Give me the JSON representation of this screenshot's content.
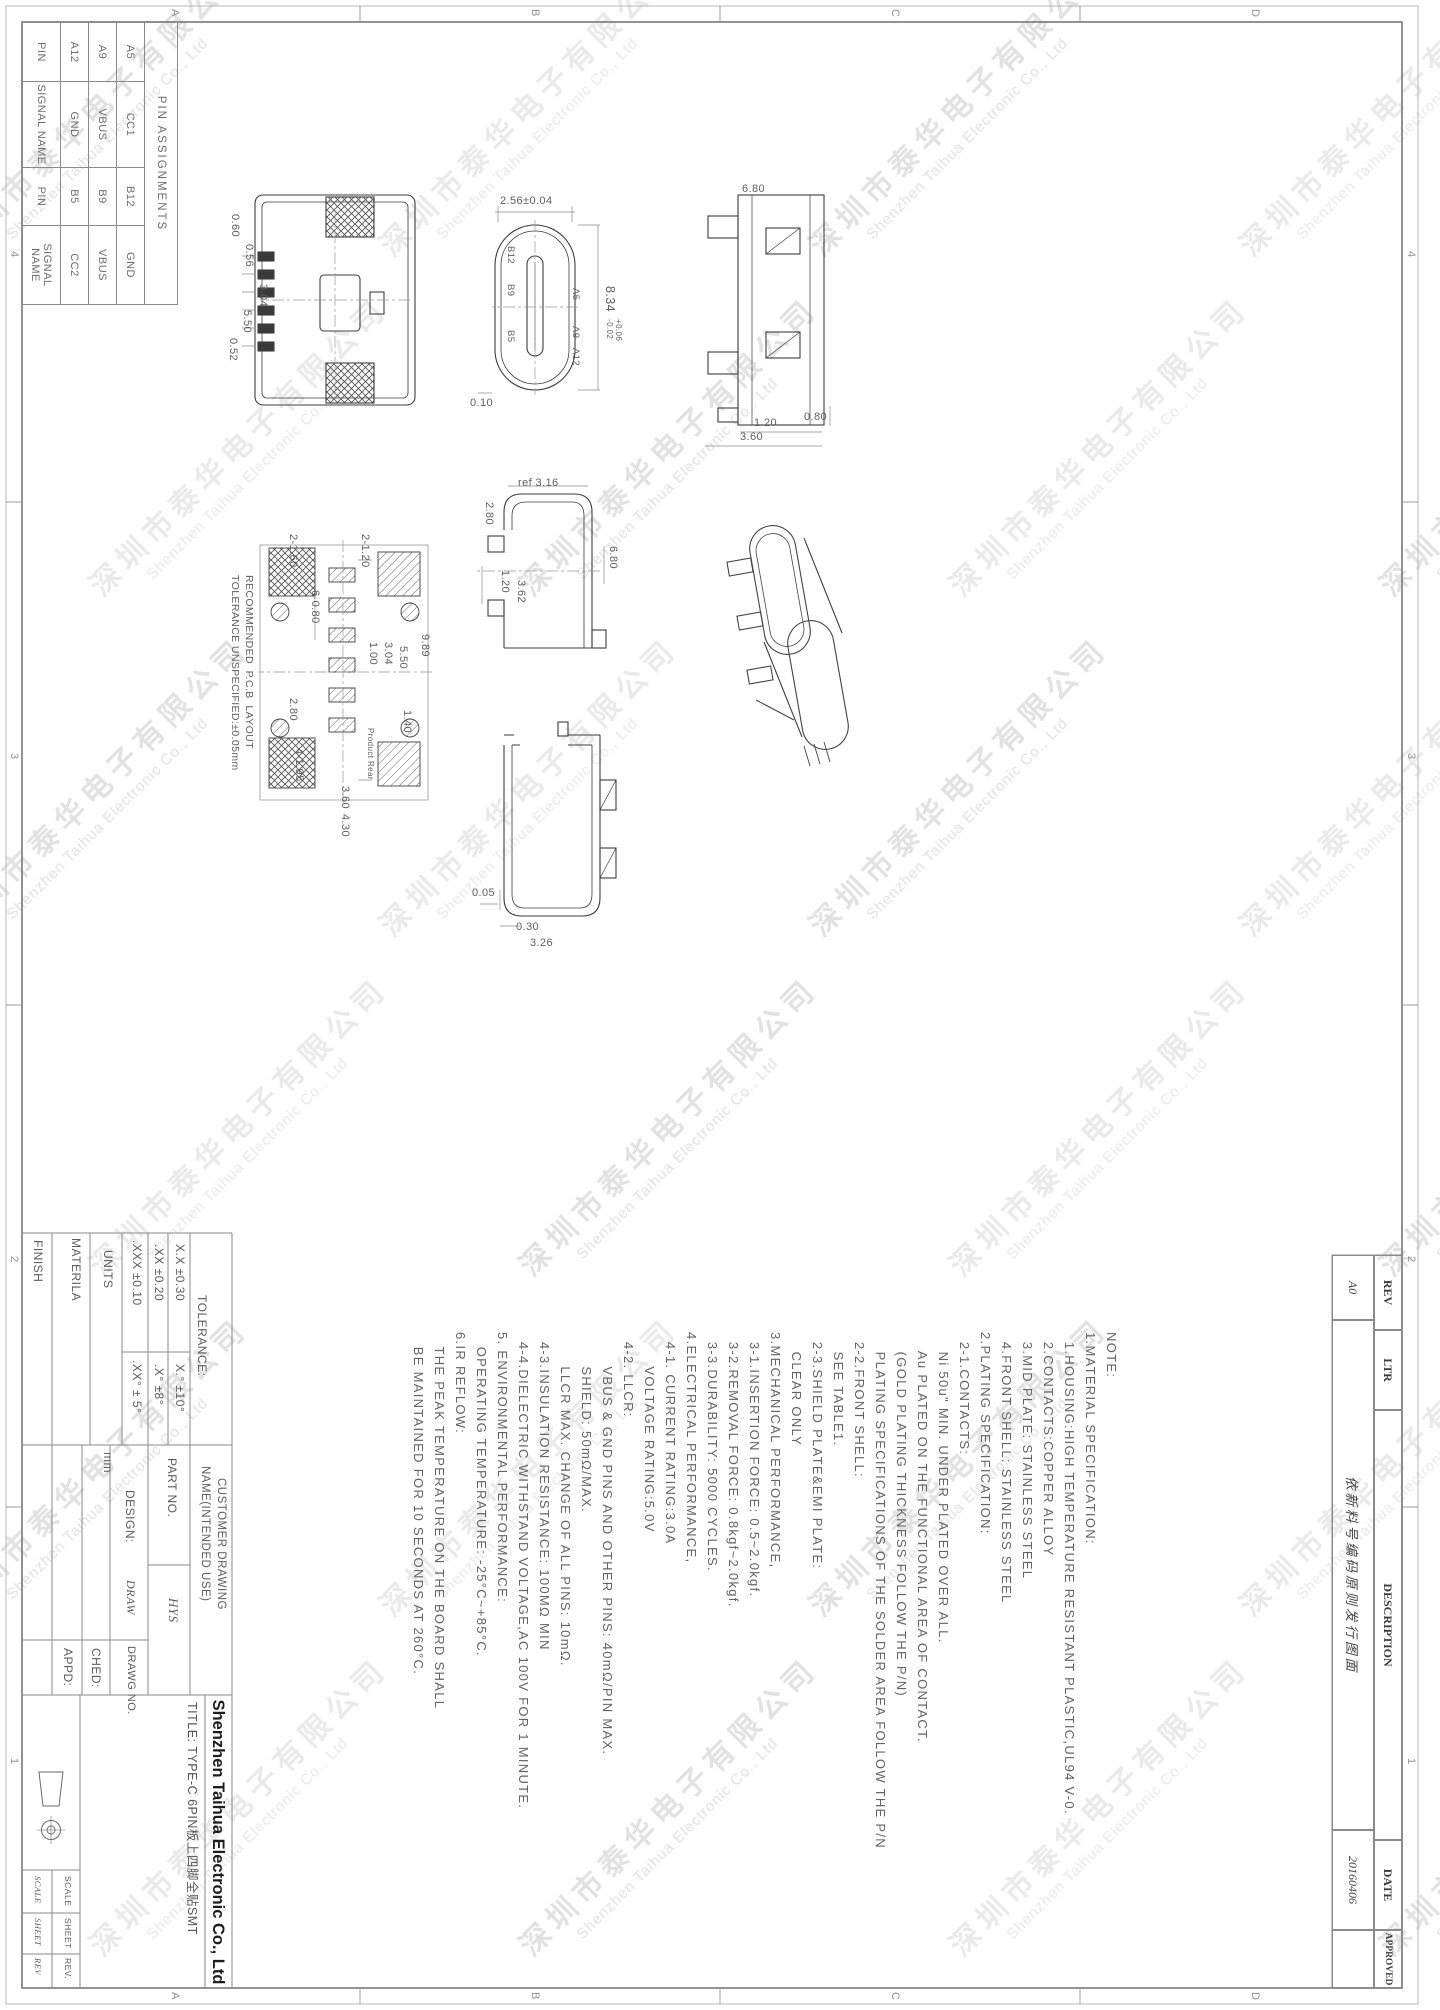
{
  "watermark": {
    "cn": "深圳市泰华电子有限公司",
    "en": "Shenzhen Taihua Electronic Co., Ltd"
  },
  "frame": {
    "zone_numbers": [
      "4",
      "3",
      "2",
      "1"
    ],
    "zone_letters": [
      "D",
      "C",
      "B",
      "A"
    ]
  },
  "pin_table": {
    "title": "PIN ASSIGNMENTS",
    "headers": [
      "PIN",
      "SIGNAL NAME",
      "PIN",
      "SIGNAL NAME"
    ],
    "rows": [
      [
        "A5",
        "CC1",
        "B12",
        "GND"
      ],
      [
        "A9",
        "VBUS",
        "B9",
        "VBUS"
      ],
      [
        "A12",
        "GND",
        "B5",
        "CC2"
      ]
    ]
  },
  "rev_table": {
    "headers": [
      "REV",
      "LTR",
      "DESCRIPTION",
      "DATE",
      "APPROVED"
    ],
    "rev": "A0",
    "description": "依新料号编码原则发行图面",
    "date": "20160406",
    "approved": ""
  },
  "notes": {
    "lines": [
      "NOTE:",
      "1.MATERIAL SPECIFICATION:",
      "  1.HOUSING:HIGH TEMPERATURE RESISTANT PLASTIC,UL94 V-0.",
      "  2.CONTACTS:COPPER ALLOY",
      "  3.MID PLATE: STAINLESS STEEL",
      "  4.FRONT SHELL: STAINLESS STEEL",
      "2.PLATING SPECIFICATION:",
      "  2-1.CONTACTS:",
      "    Ni 50u\" MIN. UNDER PLATED OVER ALL.",
      "    Au PLATED ON THE FUNCTIONAL AREA OF CONTACT.",
      "    (GOLD PLATING THICKNESS FOLLOW THE P/N)",
      "    PLATING SPECIFICATIONS OF THE SOLDER AREA FOLLOW THE P/N",
      "  2-2.FRONT SHELL:",
      "    SEE TABLE1.",
      "  2-3.SHIELD PLATE&EMI PLATE:",
      "    CLEAR ONLY",
      "3.MECHANICAL PERFORMANCE,",
      "  3-1.INSERTION FORCE: 0.5~2.0kgf.",
      "  3-2.REMOVAL FORCE: 0.8kgf~2.0kgf.",
      "  3-3.DURABILITY: 5000 CYCLES.",
      "4.ELECTRICAL PERFORMANCE,",
      "  4-1. CURRENT RATING:3.0A",
      "       VOLTAGE RATING:5.0V",
      "  4-2. LLCR:",
      "       VBUS & GND PINS AND OTHER PINS: 40mΩ/PIN MAX.",
      "       SHIELD: 50mΩ/MAX.",
      "       LLCR MAX. CHANGE OF ALL PINS: 10mΩ.",
      "  4-3.INSULATION RESISTANCE: 100MΩ MIN",
      "  4-4.DIELECTRIC WITHSTAND VOLTAGE,AC 100V FOR 1 MINUTE.",
      "5. ENVIRONMENTAL PERFORMANCE:",
      "   OPERATING TEMPERATURE: -25°C~+85°C.",
      "6.IR REFLOW:",
      "   THE PEAK TEMPERATURE ON THE BOARD SHALL",
      "   BE MAINTAINED FOR 10 SECONDS AT 260°C."
    ]
  },
  "title_block": {
    "tolerance_label": "TOLERANCE:",
    "tol_lin": [
      "X.X ±0.30",
      ".XX ±0.20",
      ".XXX ±0.10"
    ],
    "tol_ang": [
      "X.°  ±10°",
      ".X°  ±8°",
      ".XX°  ± 5°"
    ],
    "units_label": "UNITS",
    "units_value": "mm",
    "material_label": "MATERILA",
    "finish_label": "FINISH",
    "customer": "CUSTOMER  DRAWING",
    "name_label": "NAME(INTENDED  USE)",
    "part_no_label": "PART  NO.",
    "part_no_value": "HYS",
    "design_label": "DESIGN:",
    "design_value": "DRAW",
    "drawg_no_label": "DRAWG  NO.",
    "ched_label": "CHED:",
    "appd_label": "APPD:",
    "company": "Shenzhen Taihua Electronic Co., Ltd",
    "title": "TITLE: TYPE-C 6PIN板上四脚全贴SMT",
    "scale_label": "SCALE",
    "sheet_label": "SHEET",
    "rev_label": "REV.",
    "scale_value": "SCALE",
    "sheet_value": "SHEET",
    "rev_value": "REV"
  },
  "dims": [
    "0.60",
    "0.56",
    "3.04",
    "5.50",
    "0.52",
    "2.56±0.04",
    "8.34",
    "+0.06",
    "-0.02",
    "B12",
    "B9",
    "B5",
    "A5",
    "A9",
    "A12",
    "0.10",
    "6.80",
    "0.80",
    "1.20",
    "3.60",
    "ref 3.16",
    "2.80",
    "6.80",
    "1.20",
    "3.62",
    "2-1.60",
    "2-1.20",
    "6-0.80",
    "9.89",
    "5.50",
    "3.04",
    "1.00",
    "1.40",
    "2.80",
    "4-1.95",
    "3.60",
    "4.30",
    "RECOMMENDED  P.C.B  LAYOUT",
    "TOLERANCE UNSPECIFIED:±0.05mm",
    "Product Rear",
    "0.05",
    "0.30",
    "3.26"
  ]
}
